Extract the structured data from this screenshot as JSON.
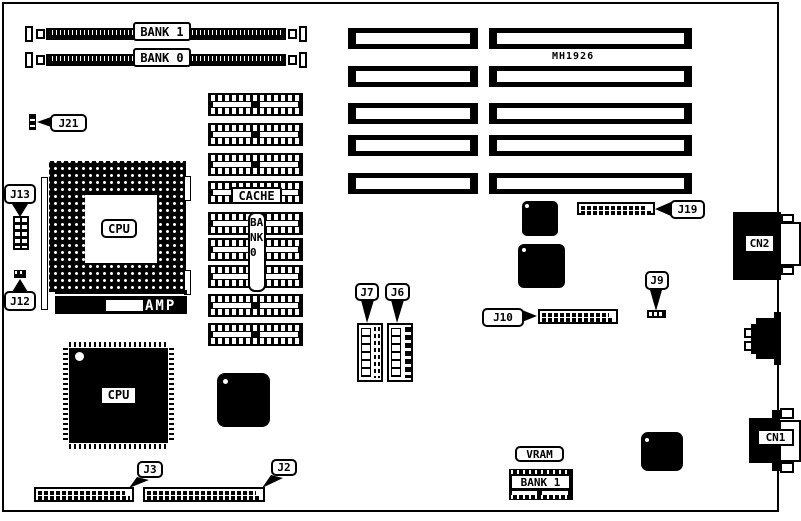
{
  "colors": {
    "ink": "#000000",
    "paper": "#ffffff"
  },
  "memory": {
    "bank1_slot": "BANK 1",
    "bank0_slot": "BANK 0",
    "cache": "CACHE",
    "bank0_column": "BANK 0",
    "vram": "VRAM",
    "vram_bank": "BANK 1"
  },
  "chips": {
    "cpu_socket": "CPU",
    "cpu_qfp": "CPU",
    "amp": "AMP",
    "chipset": "MH1926"
  },
  "ports": {
    "cn1": "CN1",
    "cn2": "CN2"
  },
  "jumpers": {
    "j2": "J2",
    "j3": "J3",
    "j6": "J6",
    "j7": "J7",
    "j9": "J9",
    "j10": "J10",
    "j12": "J12",
    "j13": "J13",
    "j19": "J19",
    "j21": "J21"
  }
}
